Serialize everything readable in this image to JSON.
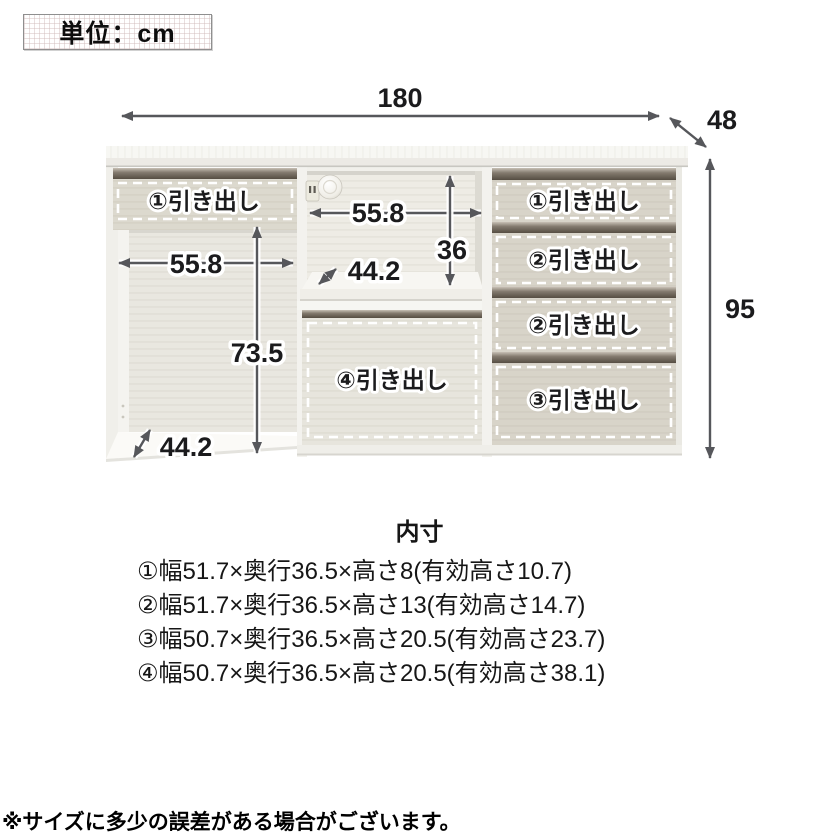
{
  "unit_box": {
    "label": "単位：cm"
  },
  "diagram": {
    "overall": {
      "width": "180",
      "depth": "48",
      "height": "95"
    },
    "left_section": {
      "drawer_label": "①引き出し",
      "inner_width": "55.8",
      "inner_height": "73.5",
      "inner_depth": "44.2"
    },
    "middle_section": {
      "inner_width": "55.8",
      "inner_height": "36",
      "inner_depth": "44.2",
      "drawer_label": "④引き出し"
    },
    "right_section": {
      "drawer_labels": [
        "①引き出し",
        "②引き出し",
        "②引き出し",
        "③引き出し"
      ]
    }
  },
  "specs": {
    "title": "内寸",
    "lines": [
      "①幅51.7×奥行36.5×高さ8(有効高さ10.7)",
      "②幅51.7×奥行36.5×高さ13(有効高さ14.7)",
      "③幅50.7×奥行36.5×高さ20.5(有効高さ23.7)",
      "④幅50.7×奥行36.5×高さ20.5(有効高さ38.1)"
    ]
  },
  "note": "※サイズに多少の誤差がある場合がございます。",
  "colors": {
    "rail_dark": "#6e665b",
    "cabinet_frame": "#f3f2ee",
    "drawer_front": "#d8d4c9",
    "arrow": "#56575b"
  }
}
